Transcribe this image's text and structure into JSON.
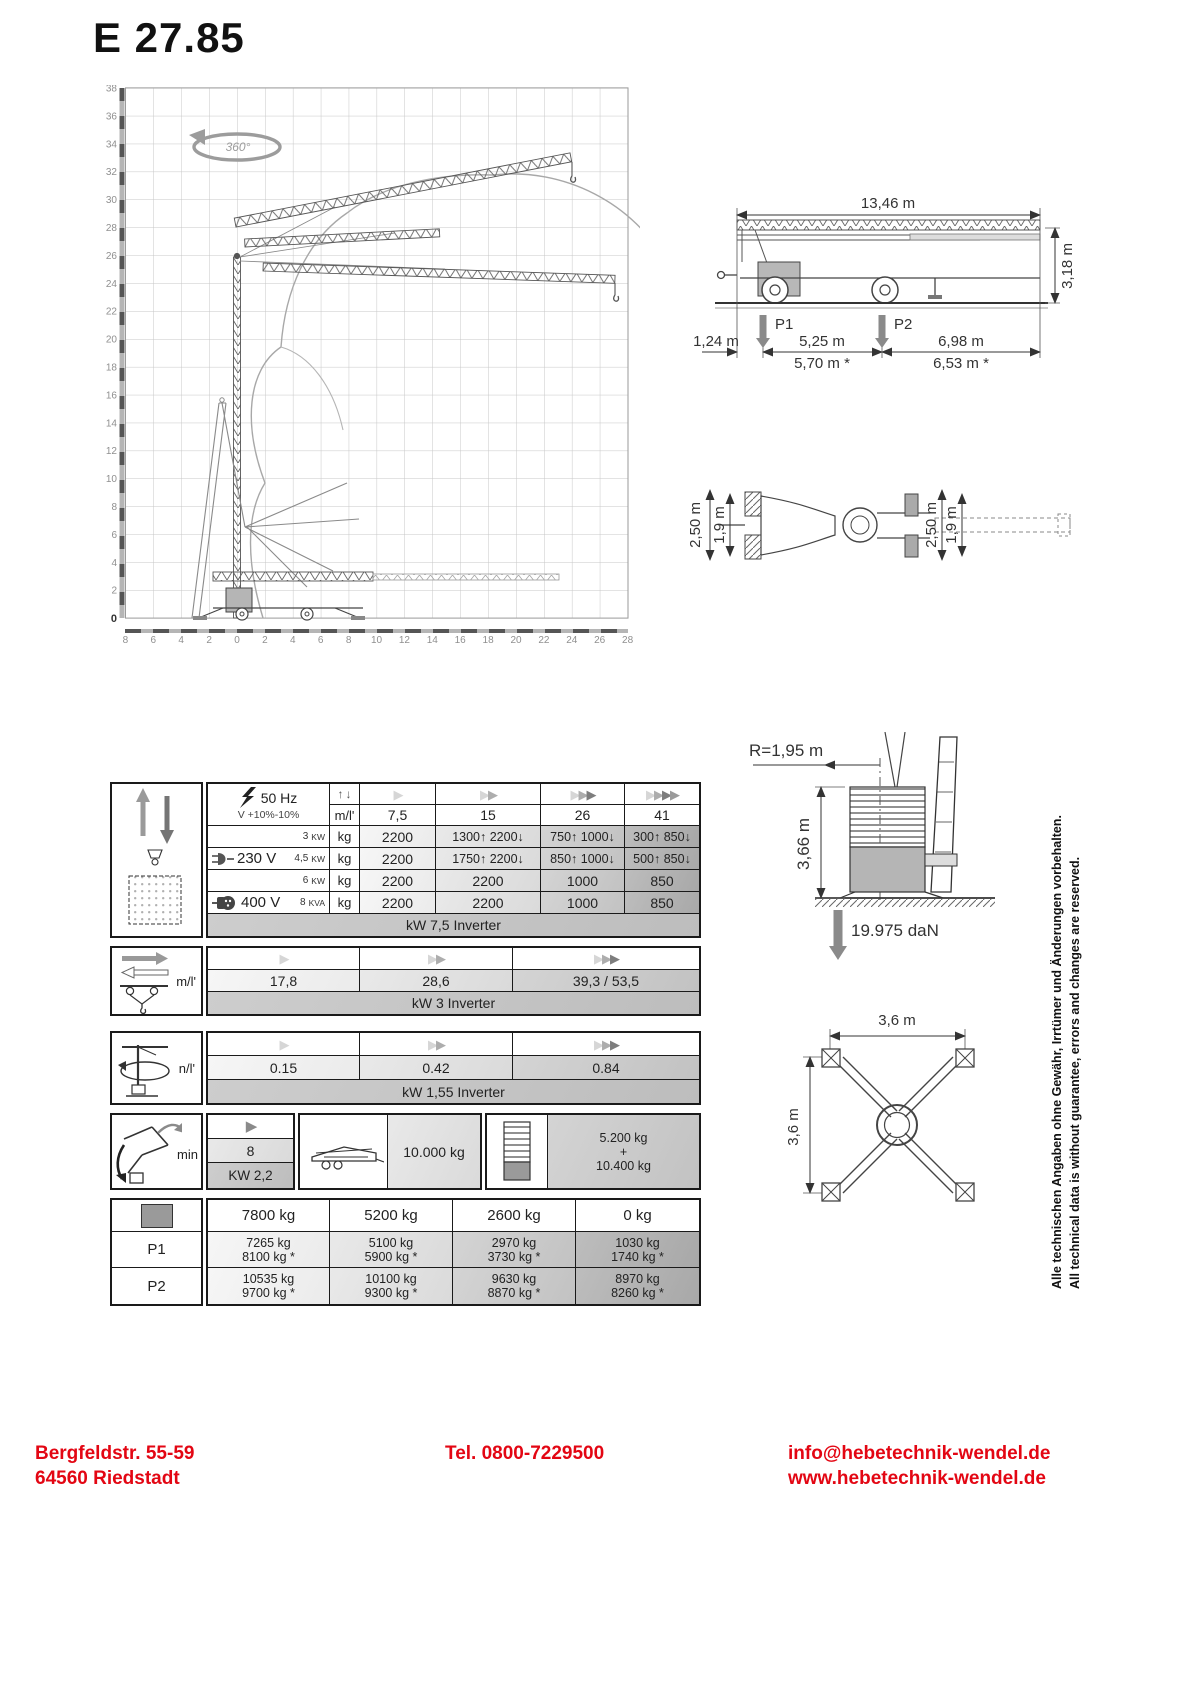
{
  "title": "E 27.85",
  "range_diagram": {
    "rotation": "360°",
    "y_ticks": [
      "38",
      "36",
      "34",
      "32",
      "30",
      "28",
      "26",
      "24",
      "22",
      "20",
      "18",
      "16",
      "14",
      "12",
      "10",
      "8",
      "6",
      "4",
      "2"
    ],
    "origin": "0",
    "x_ticks": [
      "8",
      "6",
      "4",
      "2",
      "0",
      "2",
      "4",
      "6",
      "8",
      "10",
      "12",
      "14",
      "16",
      "18",
      "20",
      "22",
      "24",
      "26",
      "28"
    ]
  },
  "side_view": {
    "total_length": "13,46 m",
    "height": "3,18 m",
    "front_overhang": "1,24 m",
    "span1": "5,25 m",
    "span1_alt": "5,70 m *",
    "span2": "6,98 m",
    "span2_alt": "6,53 m *",
    "p1_label": "P1",
    "p2_label": "P2"
  },
  "top_view": {
    "width_left_outer": "2,50 m",
    "width_left_inner": "1,9 m",
    "width_right_outer": "2,50 m",
    "width_right_inner": "1,9 m"
  },
  "hoist": {
    "frequency": "50 Hz",
    "voltage_tol": "V +10%-10%",
    "unit": "m/l'",
    "speed_headers": [
      "7,5",
      "15",
      "26",
      "41"
    ],
    "rows": [
      {
        "voltage": "",
        "power": "3",
        "punit": "KW",
        "unit": "kg",
        "v1": "2200",
        "v2": "1300↑ 2200↓",
        "v3": "750↑ 1000↓",
        "v4": "300↑ 850↓"
      },
      {
        "voltage": "230 V",
        "power": "4,5",
        "punit": "KW",
        "unit": "kg",
        "v1": "2200",
        "v2": "1750↑ 2200↓",
        "v3": "850↑ 1000↓",
        "v4": "500↑ 850↓"
      },
      {
        "voltage": "",
        "power": "6",
        "punit": "KW",
        "unit": "kg",
        "v1": "2200",
        "v2": "2200",
        "v3": "1000",
        "v4": "850"
      },
      {
        "voltage": "400 V",
        "power": "8",
        "punit": "KVA",
        "unit": "kg",
        "v1": "2200",
        "v2": "2200",
        "v3": "1000",
        "v4": "850"
      }
    ],
    "footer": "kW 7,5  Inverter"
  },
  "trolley": {
    "unit": "m/l'",
    "v1": "17,8",
    "v2": "28,6",
    "v3": "39,3 / 53,5",
    "footer": "kW 3  Inverter"
  },
  "slewing": {
    "unit": "n/l'",
    "v1": "0.15",
    "v2": "0.42",
    "v3": "0.84",
    "footer": "kW  1,55 Inverter"
  },
  "erection": {
    "label": "min",
    "value": "8",
    "power": "KW 2,2",
    "transport": "10.000 kg",
    "ballast_l1": "5.200 kg",
    "ballast_l2": "+",
    "ballast_l3": "10.400 kg"
  },
  "corner_loads": {
    "headers": [
      "7800 kg",
      "5200 kg",
      "2600 kg",
      "0 kg"
    ],
    "p1": {
      "label": "P1",
      "c1l1": "7265 kg",
      "c1l2": "8100 kg *",
      "c2l1": "5100 kg",
      "c2l2": "5900 kg *",
      "c3l1": "2970 kg",
      "c3l2": "3730 kg *",
      "c4l1": "1030 kg",
      "c4l2": "1740 kg *"
    },
    "p2": {
      "label": "P2",
      "c1l1": "10535 kg",
      "c1l2": "9700 kg *",
      "c2l1": "10100 kg",
      "c2l2": "9300 kg *",
      "c3l1": "9630 kg",
      "c3l2": "8870 kg *",
      "c4l1": "8970 kg",
      "c4l2": "8260 kg *"
    }
  },
  "rear_view": {
    "radius": "R=1,95 m",
    "height": "3,66 m",
    "force": "19.975 daN"
  },
  "base": {
    "width": "3,6 m",
    "depth": "3,6  m"
  },
  "disclaimer": {
    "de": "Alle technischen Angaben ohne Gewähr, Irrtümer und Änderungen vorbehalten.",
    "en": "All technical data is without guarantee, errors and changes are reserved."
  },
  "footer": {
    "address1": "Bergfeldstr. 55-59",
    "address2": "64560 Riedstadt",
    "phone": "Tel.  0800-7229500",
    "email": "info@hebetechnik-wendel.de",
    "web": "www.hebetechnik-wendel.de"
  },
  "colors": {
    "accent_red": "#e30613"
  }
}
